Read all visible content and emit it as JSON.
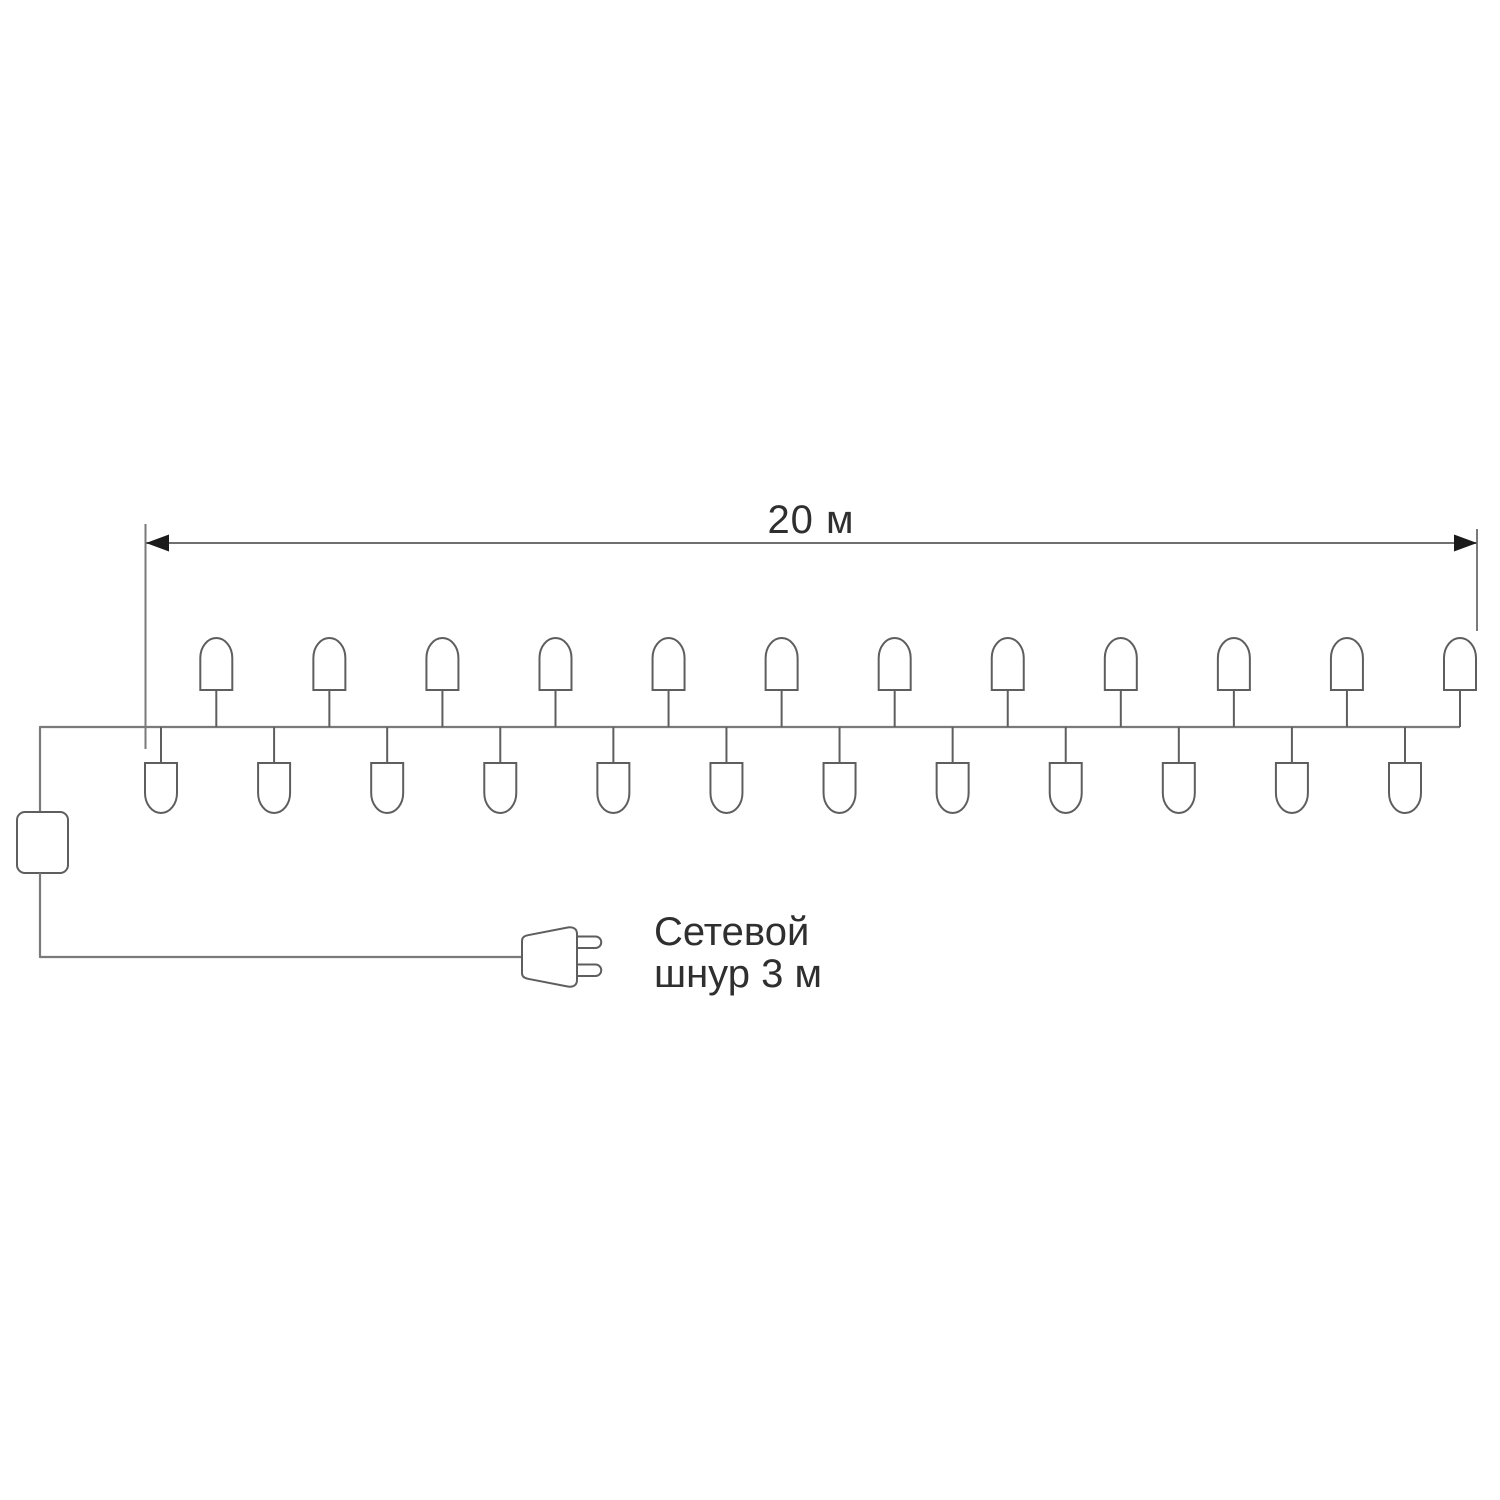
{
  "diagram": {
    "dimension": {
      "label": "20 м"
    },
    "cord_label": {
      "line1": "Сетевой",
      "line2": "шнур 3 м"
    },
    "garland": {
      "top_bulb_count": 12,
      "bottom_bulb_count": 12
    },
    "colors": {
      "background": "#ffffff",
      "wire": "#7a7a7a",
      "bulb_outline": "#5e5e5e",
      "dimension_line": "#6f6f6f",
      "arrow": "#1a1a1a",
      "label_text": "#2f2f2f"
    }
  }
}
